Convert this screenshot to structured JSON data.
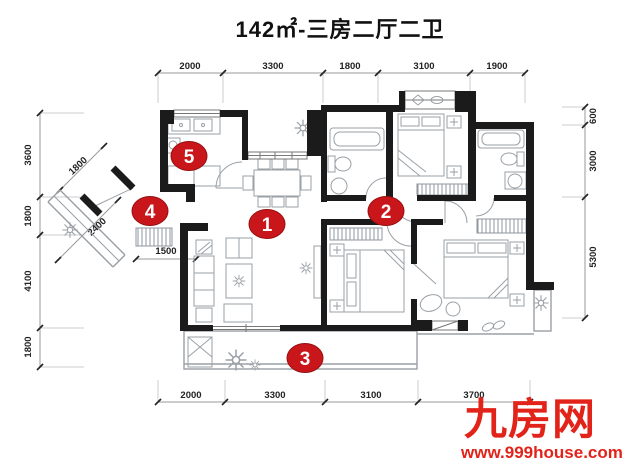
{
  "title": "142㎡-三房二厅二卫",
  "dimensions": {
    "top": [
      "2000",
      "3300",
      "1800",
      "3100",
      "1900"
    ],
    "bottom": [
      "2000",
      "3300",
      "3100",
      "3700"
    ],
    "left": [
      "3600",
      "1800",
      "4100",
      "1800"
    ],
    "right": [
      "600",
      "3000",
      "5300"
    ],
    "entry": {
      "upper_diagonal": "1800",
      "lower_diagonal": "2400",
      "foyer": "1500"
    }
  },
  "markers": [
    "1",
    "2",
    "3",
    "4",
    "5"
  ],
  "watermark": {
    "brand": "九房网",
    "url": "www.999house.com"
  },
  "colors": {
    "wall": "#1b1b1b",
    "furniture": "#9aa0a6",
    "marker_red": "#c8161b",
    "watermark_red": "#e2231a"
  }
}
